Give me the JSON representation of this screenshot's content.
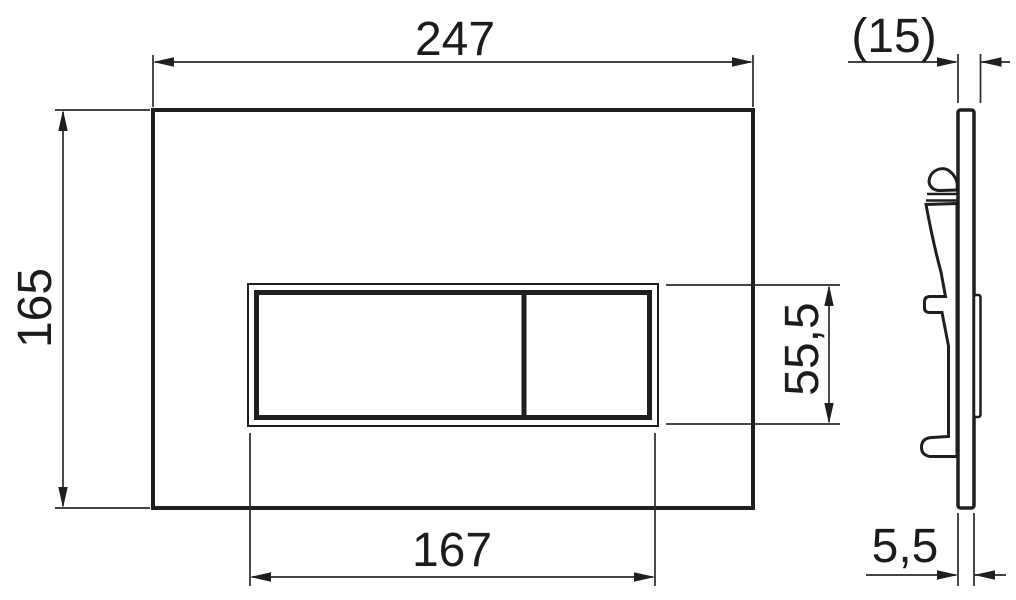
{
  "drawing": {
    "background_color": "#ffffff",
    "line_color": "#1f1f1f",
    "front_view": {
      "width": "247",
      "height": "165",
      "button_width": "167",
      "button_height": "55,5"
    },
    "side_view": {
      "depth": "(15)",
      "thickness": "5,5"
    }
  }
}
